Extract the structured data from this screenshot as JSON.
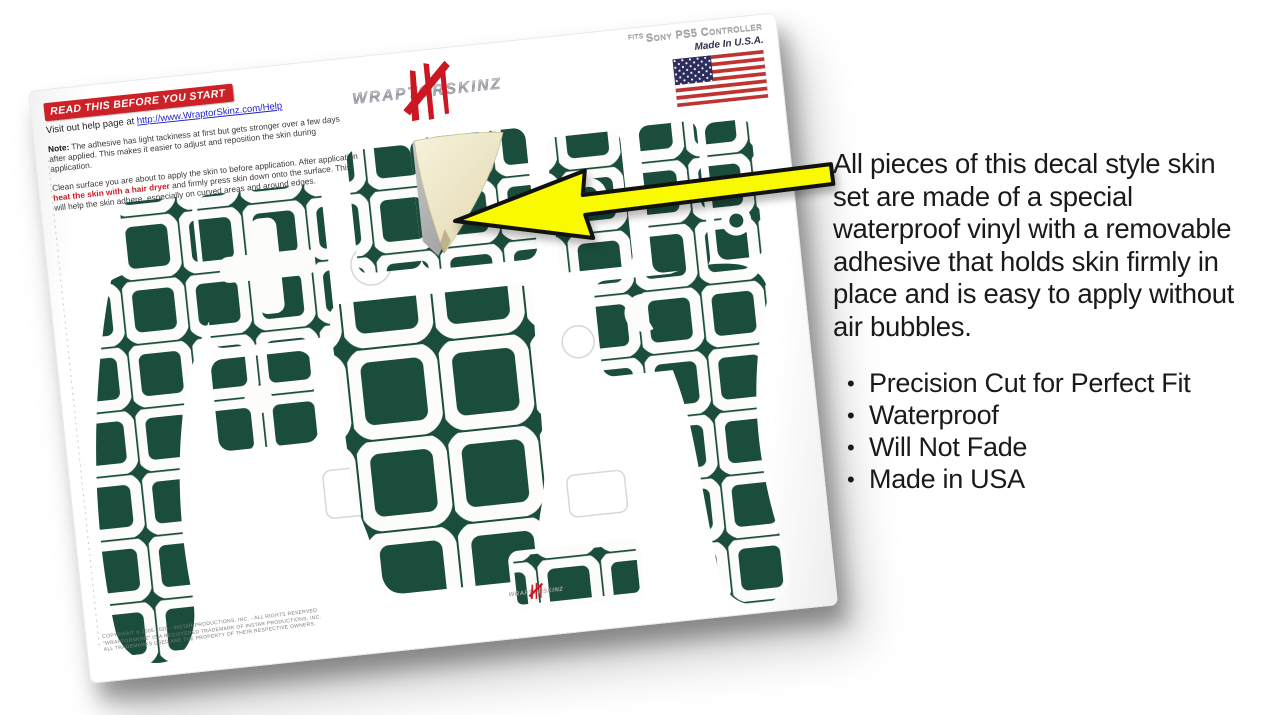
{
  "colors": {
    "green": "#1b4d3d",
    "paper": "#fcfcfb",
    "cream": "#efe8c8",
    "arrowYellow": "#f9f900",
    "ink": "#111111",
    "bannerRed": "#cc2127",
    "linkBlue": "#1d1dcc",
    "textDark": "#1a1a1a",
    "flagRed": "#bf3330",
    "flagBlue": "#2d2d5e",
    "logoRed": "#cc1722",
    "silver": "#a9a9b2",
    "ghost": "#d7d7d7"
  },
  "sheet": {
    "read_banner": "READ THIS BEFORE YOU START",
    "help_prefix": "Visit out help page at ",
    "help_link": "http://www.WraptorSkinz.com/Help",
    "note_label": "Note:",
    "note_text": " The adhesive has light tackiness at first but gets stronger over a few days after applied. This makes it easier to adjust and reposition the skin during application.",
    "clean_pre": "Clean surface you are about to apply the skin to before application. After application ",
    "clean_red": "heat the skin with a hair dryer",
    "clean_post": " and firmly press skin down onto the surface. This will help the skin adhere, especially on curved areas and around edges.",
    "brand": "WRAPTORSKINZ",
    "fits_small": "FITS",
    "fits_line": "Sony PS5 Controller",
    "made_in": "Made In U.S.A.",
    "copyright_line1": "COPYRIGHT © 2005-2020 - INSTAR PRODUCTIONS, INC. - ALL RIGHTS RESERVED",
    "copyright_line2": "\"WRAPTORSKINZ\" IS A REGISTERED TRADEMARK OF INSTAR PRODUCTIONS, INC.",
    "copyright_line3": "ALL TRADEMARKS USED ARE THE PROPERTY OF THEIR RESPECTIVE OWNERS."
  },
  "info": {
    "paragraph": "All pieces of this decal style skin set are made of a special waterproof vinyl with a removable adhesive that holds skin firmly in place and is easy to apply without air bubbles.",
    "bullets": [
      "Precision Cut for Perfect Fit",
      "Waterproof",
      "Will Not Fade",
      "Made in USA"
    ]
  },
  "icons": {
    "flag": "us-flag",
    "arrow": "left-pointer-arrow",
    "logo": "wraptorskinz-claw-logo"
  }
}
